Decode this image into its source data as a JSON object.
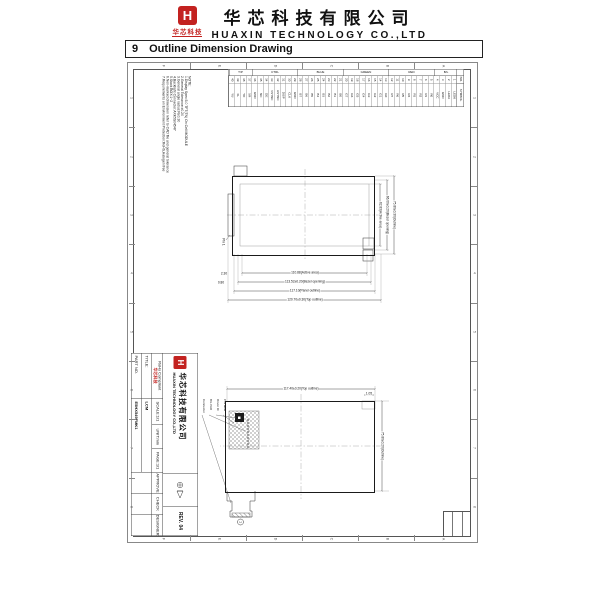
{
  "header": {
    "logo_letter": "H",
    "logo_caption": "华芯科技",
    "company_cn": "华芯科技有限公司",
    "company_en": "HUAXIN TECHNOLOGY CO.,LTD"
  },
  "section": {
    "number": "9",
    "title": "Outline Dimension Drawing"
  },
  "drawing": {
    "zones": {
      "numbers": [
        "1",
        "2",
        "3",
        "4",
        "5",
        "6",
        "7",
        "8"
      ],
      "letters": [
        "A",
        "B",
        "C",
        "D",
        "E",
        "F"
      ]
    },
    "notes": {
      "lines": [
        "NOTE:",
        "1.Display Spec:5.0 TFT(TN) On Cell MODULE",
        "2.General Tolerance:±0.20",
        "3.General angle radius:R≤0.30",
        "4.Backlight Connector:AXK5S04547",
        "5.Stack BOX:1~2",
        "6.Non-marked dimension refer to CAD file and general tolerance",
        "7.Requirements on Environment Protection:RoHS,Halogen free"
      ]
    },
    "pin_table": {
      "col_no": "NO.",
      "col_symbol": "SYMBOL",
      "groups": [
        {
          "label": "B/L",
          "span": 4
        },
        {
          "label": "RED",
          "span": 8
        },
        {
          "label": "GREEN",
          "span": 8
        },
        {
          "label": "BLUE",
          "span": 8
        },
        {
          "label": "CTRL",
          "span": 8
        },
        {
          "label": "T/P",
          "span": 4
        }
      ],
      "pins": [
        {
          "no": "1",
          "symbol": "LEDK"
        },
        {
          "no": "2",
          "symbol": "LEDA"
        },
        {
          "no": "3",
          "symbol": "GND"
        },
        {
          "no": "4",
          "symbol": "VCC"
        },
        {
          "no": "5",
          "symbol": "R0"
        },
        {
          "no": "6",
          "symbol": "R1"
        },
        {
          "no": "7",
          "symbol": "R2"
        },
        {
          "no": "8",
          "symbol": "R3"
        },
        {
          "no": "9",
          "symbol": "R4"
        },
        {
          "no": "10",
          "symbol": "R5"
        },
        {
          "no": "11",
          "symbol": "R6"
        },
        {
          "no": "12",
          "symbol": "R7"
        },
        {
          "no": "13",
          "symbol": "G0"
        },
        {
          "no": "14",
          "symbol": "G1"
        },
        {
          "no": "15",
          "symbol": "G2"
        },
        {
          "no": "16",
          "symbol": "G3"
        },
        {
          "no": "17",
          "symbol": "G4"
        },
        {
          "no": "18",
          "symbol": "G5"
        },
        {
          "no": "19",
          "symbol": "G6"
        },
        {
          "no": "20",
          "symbol": "G7"
        },
        {
          "no": "21",
          "symbol": "B0"
        },
        {
          "no": "22",
          "symbol": "B1"
        },
        {
          "no": "23",
          "symbol": "B2"
        },
        {
          "no": "24",
          "symbol": "B3"
        },
        {
          "no": "25",
          "symbol": "B4"
        },
        {
          "no": "26",
          "symbol": "B5"
        },
        {
          "no": "27",
          "symbol": "B6"
        },
        {
          "no": "28",
          "symbol": "B7"
        },
        {
          "no": "29",
          "symbol": "GND"
        },
        {
          "no": "30",
          "symbol": "CLK"
        },
        {
          "no": "31",
          "symbol": "DISP"
        },
        {
          "no": "32",
          "symbol": "HSYNC"
        },
        {
          "no": "33",
          "symbol": "VSYNC"
        },
        {
          "no": "34",
          "symbol": "DE"
        },
        {
          "no": "35",
          "symbol": "NC"
        },
        {
          "no": "36",
          "symbol": "GND"
        },
        {
          "no": "37",
          "symbol": "XR"
        },
        {
          "no": "38",
          "symbol": "YD"
        },
        {
          "no": "39",
          "symbol": "XL"
        },
        {
          "no": "40",
          "symbol": "YU"
        }
      ]
    },
    "front_view": {
      "dims_width": [
        "110.88(Active area)",
        "113.52±0.20(Bezel opening)",
        "117.10(Panel outline)",
        "120.70±0.30(Top outline)"
      ],
      "dims_height": [
        "62.83(Active area)",
        "66.00±0.20(Bezel opening)",
        "75.80±0.30(Outline)"
      ],
      "small_dims": [
        "2.30",
        "0.80"
      ],
      "pin1": "Pin 1"
    },
    "back_view": {
      "dim_width": "117.40±0.20(Top outline)",
      "dim_height": "75.80±0.20(Outline)",
      "dim_step": "1.05",
      "leaders": [
        "P/N label",
        "Driver IC",
        "B/L PAD",
        "Connector"
      ],
      "circle_marker": "1"
    },
    "title_block": {
      "part_no_label": "PART NO.",
      "part_no": "E5HX549FMK1",
      "title_label": "TITLE:",
      "title": "LCM",
      "rohs": "RoHs Compliant",
      "rohs_logo": "华芯科技",
      "scale": "SCALE:1/1",
      "unit": "UNIT:mm",
      "page": "PAGE:1/1",
      "approve": "APPROVE",
      "check": "CHECK",
      "designer": "DESIGNER",
      "company_en": "HUAXIN TECHNOLOGY CO.,LTD",
      "company_cn": "华芯科技有限公司",
      "rev": "REV. 04"
    }
  }
}
